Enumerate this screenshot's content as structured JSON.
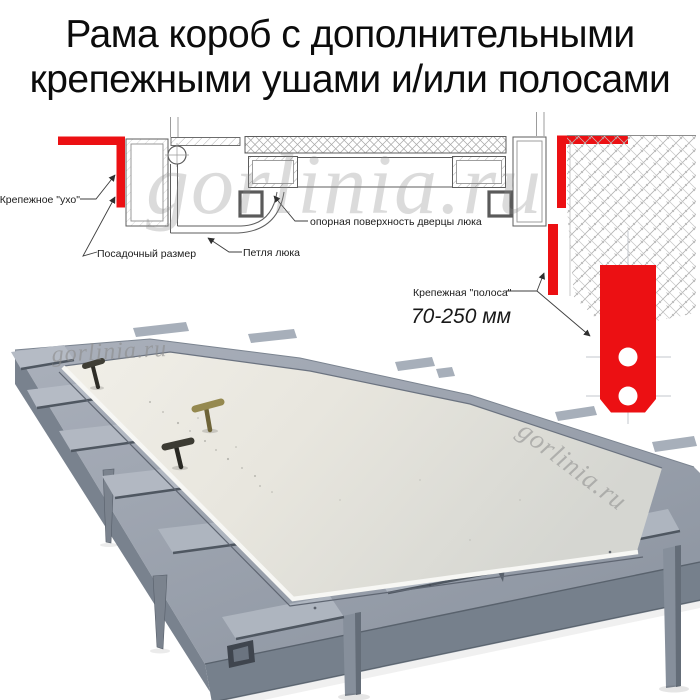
{
  "title": {
    "line1": "Рама короб с дополнительными",
    "line2": "крепежными ушами и/или полосами"
  },
  "watermark": {
    "text": "gorlinia.ru"
  },
  "diagram": {
    "label_ear": "Крепежное \"ухо\"",
    "label_seat": "Посадочный размер",
    "label_hinge": "Петля люка",
    "label_surface": "опорная поверхность дверцы люка",
    "label_strip": "Крепежная \"полоса\"",
    "label_strip_range": "70-250 мм",
    "colors": {
      "accent_red": "#ec1013",
      "line": "#5d5d5d",
      "hatch": "#b0b0b0"
    }
  },
  "photo": {
    "colors": {
      "panel": "#e9e7df",
      "frame": "#9aa2ae",
      "frame_dark": "#76808c",
      "brass_handle": "#95894f",
      "dark_handle": "#3c3b33"
    }
  }
}
